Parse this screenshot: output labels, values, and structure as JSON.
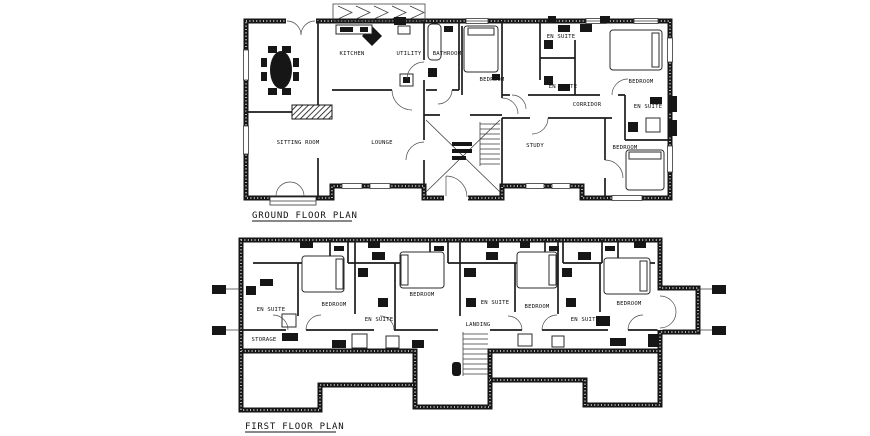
{
  "document": {
    "type": "architectural floor plan drawing",
    "paper_color": "#ffffff",
    "ink_color": "#1a1a1a"
  },
  "ground": {
    "title": "GROUND FLOOR PLAN",
    "labels": [
      {
        "text": "KITCHEN"
      },
      {
        "text": "UTILITY"
      },
      {
        "text": "BATHROOM"
      },
      {
        "text": "BEDROOM"
      },
      {
        "text": "EN SUITE"
      },
      {
        "text": "EN SUITE"
      },
      {
        "text": "BEDROOM"
      },
      {
        "text": "CORRIDOR"
      },
      {
        "text": "EN SUITE"
      },
      {
        "text": "SITTING ROOM"
      },
      {
        "text": "LOUNGE"
      },
      {
        "text": "STUDY"
      },
      {
        "text": "BEDROOM"
      }
    ]
  },
  "first": {
    "title": "FIRST FLOOR PLAN",
    "labels": [
      {
        "text": "EN SUITE"
      },
      {
        "text": "BEDROOM"
      },
      {
        "text": "EN SUITE"
      },
      {
        "text": "BEDROOM"
      },
      {
        "text": "EN SUITE"
      },
      {
        "text": "BEDROOM"
      },
      {
        "text": "EN SUITE"
      },
      {
        "text": "BEDROOM"
      },
      {
        "text": "LANDING"
      },
      {
        "text": "STORAGE"
      }
    ]
  }
}
